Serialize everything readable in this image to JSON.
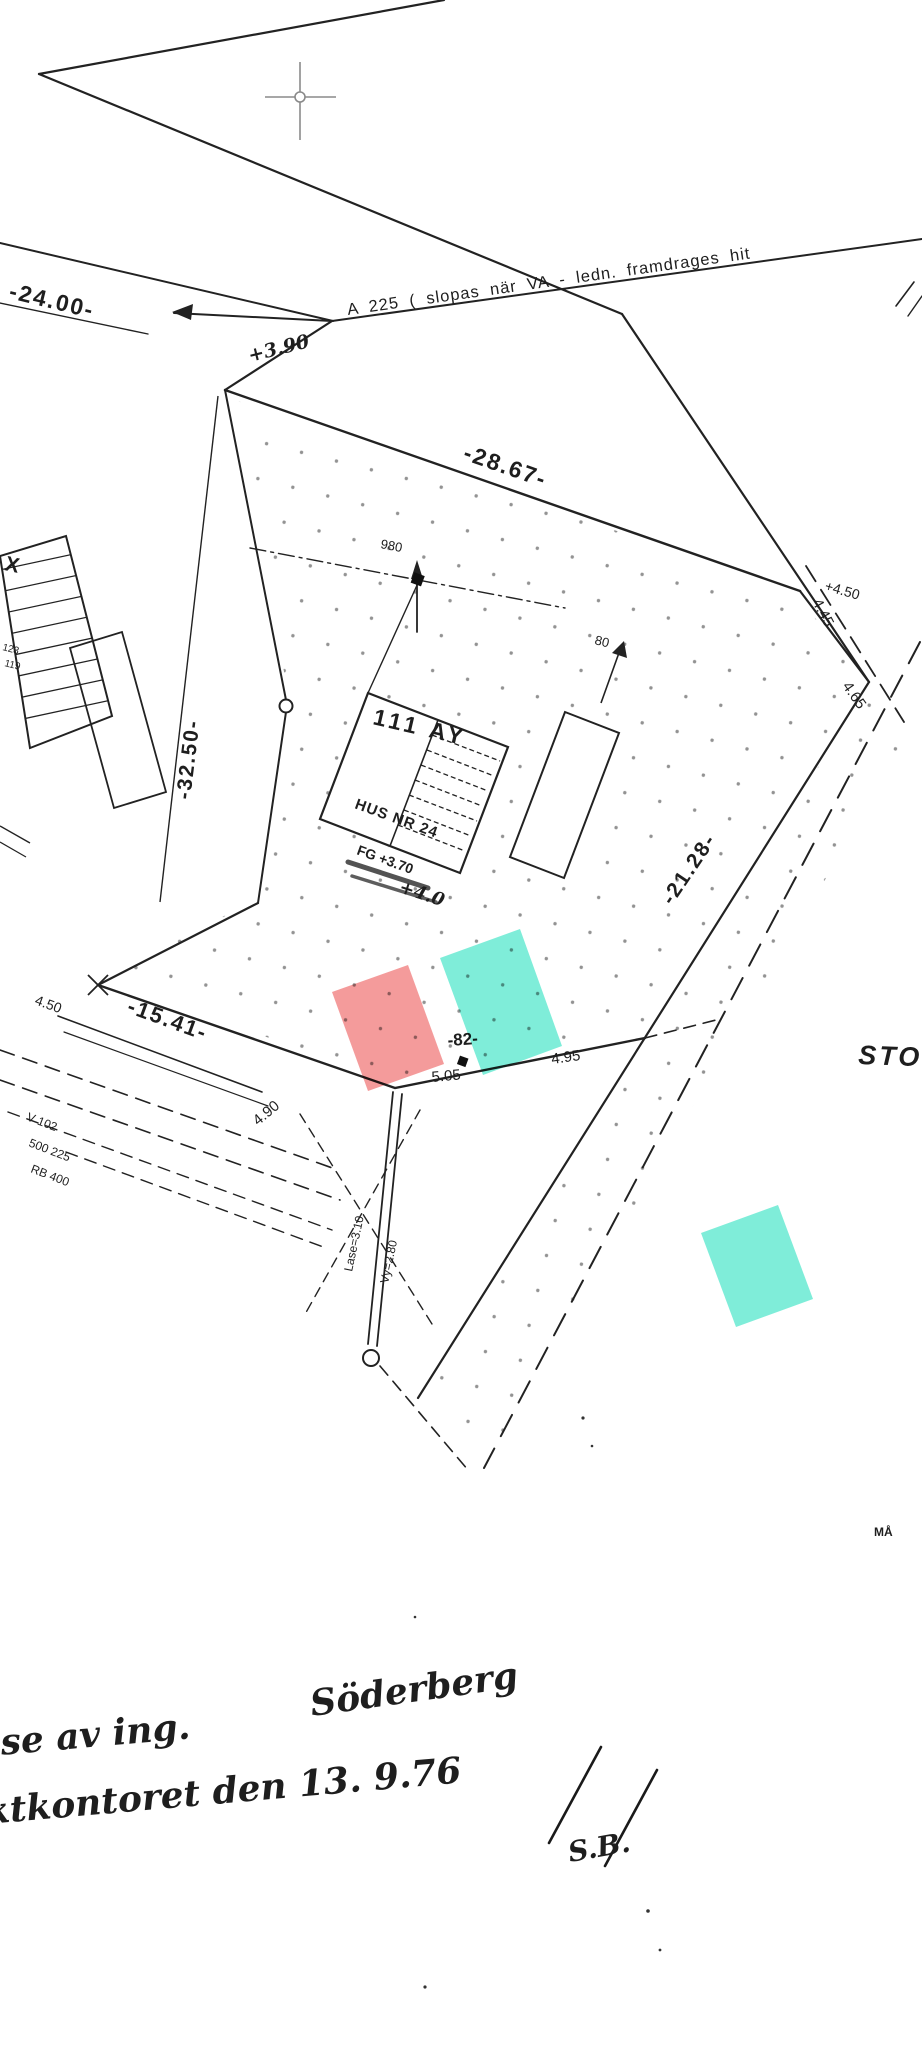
{
  "labels": {
    "dim_24": "-24.00-",
    "va_note": "A 225 ( slopas  när  VA - ledn.  framdrages  hit",
    "spot_390": "+3.90",
    "dim_2867": "-28.67-",
    "dim_3250": "-32.50-",
    "x_label": "X",
    "small_123": "123",
    "small_119": "119",
    "dist_980": "980",
    "dist_80": "80",
    "block_111ay": "111  AY",
    "hus_nr": "HUS NR 24",
    "fg_level": "FG +3.70",
    "plus_40": "+4.0",
    "spot_450_right": "+4.50",
    "dim_445": "4.45",
    "dim_465": "4.65",
    "dim_2128": "-21.28-",
    "dim_1541": "-15.41-",
    "dim_450_left": "4.50",
    "dim_490": "4.90",
    "dim_82": "-82-",
    "dim_505": "5.05",
    "dim_495": "4.95",
    "util_line_1": "V 102",
    "util_line_2": "500 225",
    "util_line_3": "RB 400",
    "pipe_note_1": "Lase=3.10",
    "pipe_note_2": "Vy=2.80",
    "street_partial": "STO",
    "note_partial": "MÅ",
    "hand_line1a": "lse  av  ing.",
    "hand_line1b": "Söderberg",
    "hand_line2": "ktkontoret  den  13. 9.76",
    "hand_initials": "S.B."
  },
  "colors": {
    "red_highlight": "#f28a8a",
    "teal_highlight": "#5fe8d0",
    "ink": "#1e1e1e"
  }
}
